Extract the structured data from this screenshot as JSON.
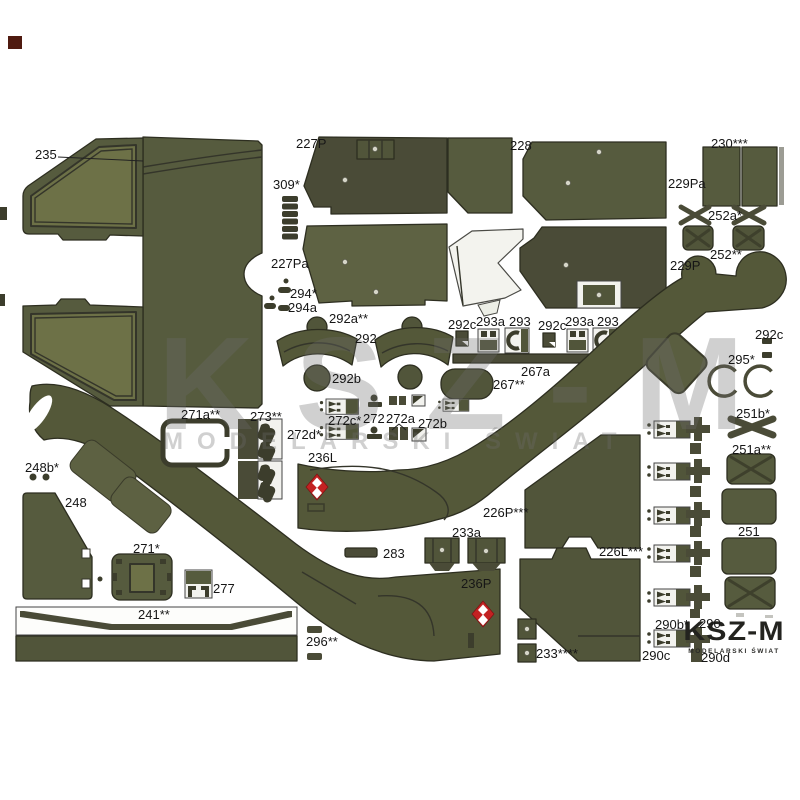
{
  "watermark": {
    "title": "KSZ-M",
    "subtitle": "MODELARSKI ŚWIAT"
  },
  "logo": {
    "title": "KSZ-M",
    "subtitle": "MODELARSKI ŚWIAT"
  },
  "colors": {
    "paper": "#ffffff",
    "olive_dark": "#4a4b37",
    "olive_medium": "#565b3e",
    "olive_medium2": "#5e6243",
    "olive_deep": "#3c3d2c",
    "olive_light": "#6d7147",
    "olive_band": "#545839",
    "olive_panel": "#51553a",
    "window_border": "#34352a",
    "outline": "#2d2e20",
    "label_ink": "#161616",
    "gray_strip": "#9c9c94",
    "insignia_red": "#c32222",
    "insignia_white": "#ffffff",
    "white_part": "#f2f2ee",
    "part_edge": "#444444",
    "watermark_gray": "rgba(110,110,110,0.32)",
    "corner_maroon": "#4f1a10"
  },
  "part_labels": [
    {
      "text": "235",
      "x": 35,
      "y": 147
    },
    {
      "text": "227P",
      "x": 296,
      "y": 136
    },
    {
      "text": "309*",
      "x": 273,
      "y": 177
    },
    {
      "text": "227Pa",
      "x": 271,
      "y": 256
    },
    {
      "text": "294*",
      "x": 290,
      "y": 286
    },
    {
      "text": "294a",
      "x": 288,
      "y": 300
    },
    {
      "text": "228",
      "x": 510,
      "y": 138
    },
    {
      "text": "229Pa",
      "x": 668,
      "y": 176
    },
    {
      "text": "229P",
      "x": 670,
      "y": 258
    },
    {
      "text": "230***",
      "x": 711,
      "y": 136
    },
    {
      "text": "252a*",
      "x": 708,
      "y": 208
    },
    {
      "text": "252**",
      "x": 710,
      "y": 247
    },
    {
      "text": "292a**",
      "x": 329,
      "y": 311
    },
    {
      "text": "292",
      "x": 355,
      "y": 331
    },
    {
      "text": "292b",
      "x": 332,
      "y": 371
    },
    {
      "text": "292c",
      "x": 448,
      "y": 317
    },
    {
      "text": "293a",
      "x": 476,
      "y": 314
    },
    {
      "text": "293",
      "x": 509,
      "y": 314
    },
    {
      "text": "292c",
      "x": 538,
      "y": 318
    },
    {
      "text": "293a",
      "x": 565,
      "y": 314
    },
    {
      "text": "293",
      "x": 597,
      "y": 314
    },
    {
      "text": "267a",
      "x": 521,
      "y": 364
    },
    {
      "text": "267**",
      "x": 493,
      "y": 377
    },
    {
      "text": "292c",
      "x": 755,
      "y": 327
    },
    {
      "text": "295*",
      "x": 728,
      "y": 352
    },
    {
      "text": "251b*",
      "x": 736,
      "y": 406
    },
    {
      "text": "271a**",
      "x": 181,
      "y": 407
    },
    {
      "text": "273**",
      "x": 250,
      "y": 409
    },
    {
      "text": "272c*",
      "x": 328,
      "y": 413
    },
    {
      "text": "272d*",
      "x": 287,
      "y": 427
    },
    {
      "text": "272",
      "x": 363,
      "y": 411
    },
    {
      "text": "272a",
      "x": 386,
      "y": 411
    },
    {
      "text": "272b",
      "x": 418,
      "y": 416
    },
    {
      "text": "236L",
      "x": 308,
      "y": 450
    },
    {
      "text": "248b*",
      "x": 25,
      "y": 460
    },
    {
      "text": "248",
      "x": 65,
      "y": 495
    },
    {
      "text": "271*",
      "x": 133,
      "y": 541
    },
    {
      "text": "277",
      "x": 213,
      "y": 581
    },
    {
      "text": "241**",
      "x": 138,
      "y": 607
    },
    {
      "text": "296**",
      "x": 306,
      "y": 634
    },
    {
      "text": "283",
      "x": 383,
      "y": 546
    },
    {
      "text": "233a",
      "x": 452,
      "y": 525
    },
    {
      "text": "236P",
      "x": 461,
      "y": 576
    },
    {
      "text": "233****",
      "x": 536,
      "y": 646
    },
    {
      "text": "226P***",
      "x": 483,
      "y": 505
    },
    {
      "text": "226L***",
      "x": 599,
      "y": 544
    },
    {
      "text": "290b*",
      "x": 655,
      "y": 617
    },
    {
      "text": "290",
      "x": 699,
      "y": 616
    },
    {
      "text": "290c",
      "x": 642,
      "y": 648
    },
    {
      "text": "290d",
      "x": 701,
      "y": 650
    },
    {
      "text": "251a**",
      "x": 732,
      "y": 442
    },
    {
      "text": "251",
      "x": 738,
      "y": 524
    }
  ]
}
